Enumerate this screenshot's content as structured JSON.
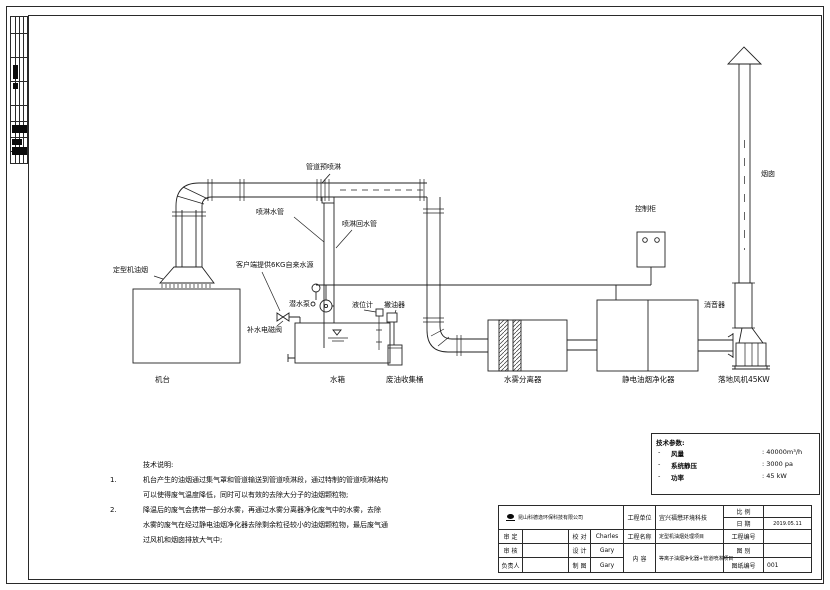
{
  "colors": {
    "line": "#222222",
    "text": "#101010"
  },
  "diagram": {
    "labels": {
      "pipe_pre_spray": "管道预喷淋",
      "spray_water_pipe": "喷淋水管",
      "spray_return_pipe": "喷淋回水管",
      "machine_fume": "定型机油烟",
      "water_source": "客户端提供6KG自来水源",
      "makeup_valve": "补水电磁阀",
      "submersible_pump": "潜水泵",
      "level_gauge": "液位计",
      "oil_skimmer": "撇油器",
      "machine": "机台",
      "water_tank": "水箱",
      "waste_oil_barrel": "废油收集桶",
      "mist_separator": "水雾分离器",
      "esp": "静电油烟净化器",
      "control_cabinet": "控制柜",
      "silencer": "消音器",
      "fan": "落地风机45KW",
      "chimney": "烟囱"
    }
  },
  "notes": {
    "title": "技术说明:",
    "items": [
      {
        "num": "1.",
        "lines": [
          "机台产生的油烟通过集气罩和管道输送到管道喷淋段，通过特制的管道喷淋结构",
          "可以使得废气温度降低，同时可以有效的去除大分子的油烟颗粒物;"
        ]
      },
      {
        "num": "2.",
        "lines": [
          "降温后的废气会携带一部分水雾，再通过水雾分离器净化废气中的水雾，去除",
          "水雾的废气在经过静电油烟净化器去除剩余粒径较小的油烟颗粒物，最后废气通",
          "过风机和烟囱排放大气中;"
        ]
      }
    ]
  },
  "tech_params": {
    "title": "技术参数:",
    "rows": [
      {
        "dash": "-",
        "name": "风量",
        "value": ": 40000m³/h"
      },
      {
        "dash": "-",
        "name": "系统静压",
        "value": ": 3000 pa"
      },
      {
        "dash": "-",
        "name": "功率",
        "value": ": 45 kW"
      }
    ]
  },
  "title_block": {
    "company": "昆山科德逸环保科技有限公司",
    "project_unit_label": "工程单位",
    "project_unit": "宜兴福懋环境科技",
    "scale_label": "比 例",
    "scale": "",
    "date_label": "日 期",
    "date": "2019.05.11",
    "rows_left": [
      {
        "label": "审 定",
        "value": "",
        "label2": "校 对",
        "value2": "Charles"
      },
      {
        "label": "审 核",
        "value": "",
        "label2": "设 计",
        "value2": "Gary"
      },
      {
        "label": "负责人",
        "value": "",
        "label2": "制 图",
        "value2": "Gary"
      }
    ],
    "project_name_label": "工程名称",
    "project_name": "定型机油烟处理项目",
    "content_label": "内 容",
    "content": "等离子油烟净化器+管道喷淋项目",
    "project_no_label": "工程编号",
    "project_no": "",
    "drawing_type_label": "图 别",
    "drawing_type": "",
    "drawing_no_label": "图纸编号",
    "drawing_no": "001"
  }
}
